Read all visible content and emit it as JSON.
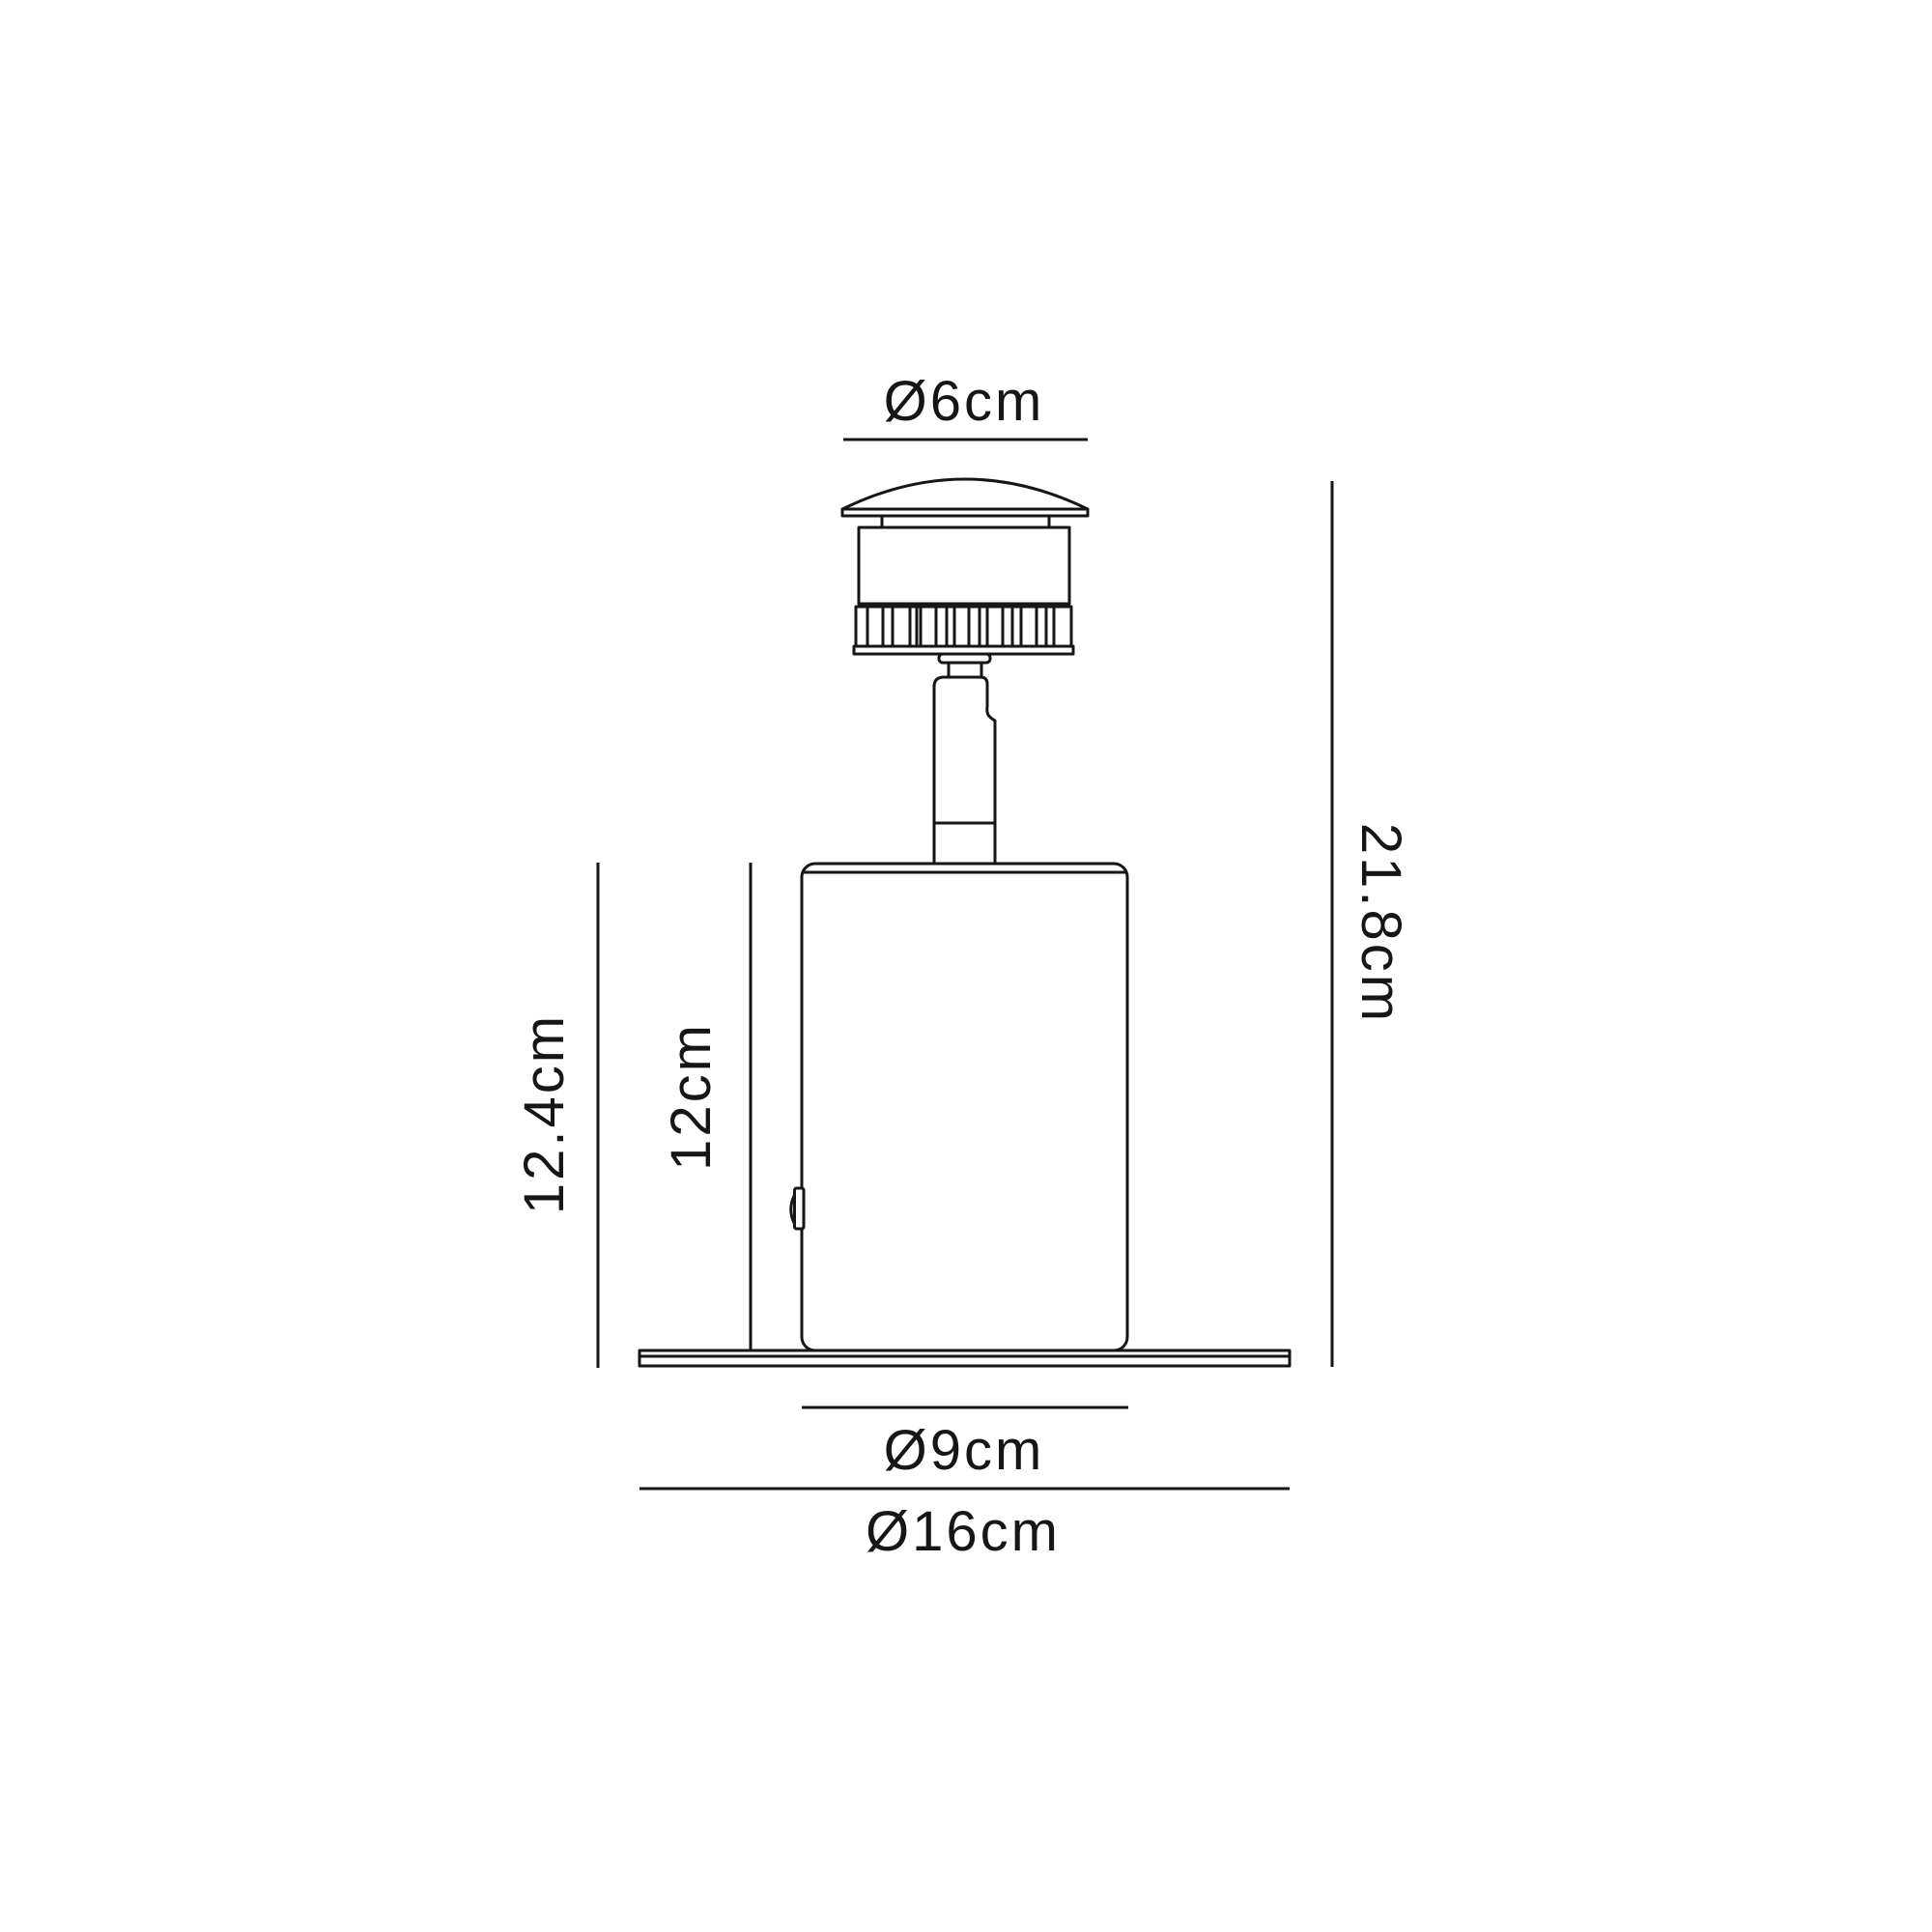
{
  "title": "Spike light fixture dimension drawing",
  "colors": {
    "background": "#ffffff",
    "line": "#161616",
    "text": "#161616"
  },
  "dimensions": {
    "cap_diameter": {
      "label": "Ø6cm",
      "value_cm": 6
    },
    "body_diameter": {
      "label": "Ø9cm",
      "value_cm": 9
    },
    "base_plate_diameter": {
      "label": "Ø16cm",
      "value_cm": 16
    },
    "total_height": {
      "label": "21.8cm",
      "value_cm": 21.8
    },
    "body_with_base_height": {
      "label": "12.4cm",
      "value_cm": 12.4
    },
    "body_height": {
      "label": "12cm",
      "value_cm": 12
    }
  }
}
